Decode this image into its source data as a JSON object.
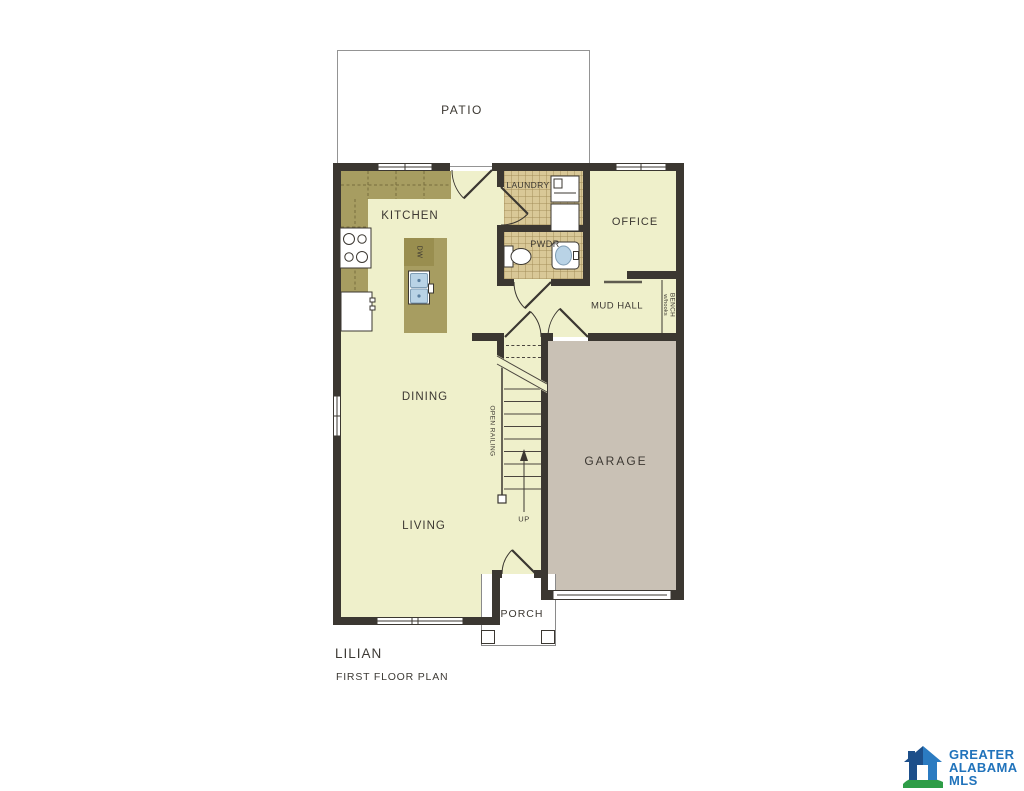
{
  "plan": {
    "name": "LILIAN",
    "subtitle": "FIRST FLOOR PLAN",
    "rooms": {
      "patio": "PATIO",
      "kitchen": "KITCHEN",
      "laundry": "LAUNDRY",
      "office": "OFFICE",
      "pwdr": "PWDR",
      "mud_hall": "MUD HALL",
      "dining": "DINING",
      "living": "LIVING",
      "garage": "GARAGE",
      "porch": "PORCH"
    },
    "annotations": {
      "dw": "DW",
      "up": "UP",
      "open_railing": "OPEN RAILING",
      "bench": "BENCH",
      "bench_sub": "w/hooks"
    }
  },
  "logo": {
    "line1": "GREATER",
    "line2": "ALABAMA",
    "line3": "MLS"
  },
  "colors": {
    "floor": "#EFF0CB",
    "tile": "#D9C897",
    "counter": "#A79D61",
    "counter_dark": "#998E4F",
    "garage_floor": "#C9C1B5",
    "wall": "#3B3731",
    "fixture_blue": "#B9D3E6",
    "logo_blue": "#2B7BC1",
    "logo_navy": "#1D4F8A",
    "logo_green": "#2E9D47",
    "logo_text": "#2173BB"
  }
}
